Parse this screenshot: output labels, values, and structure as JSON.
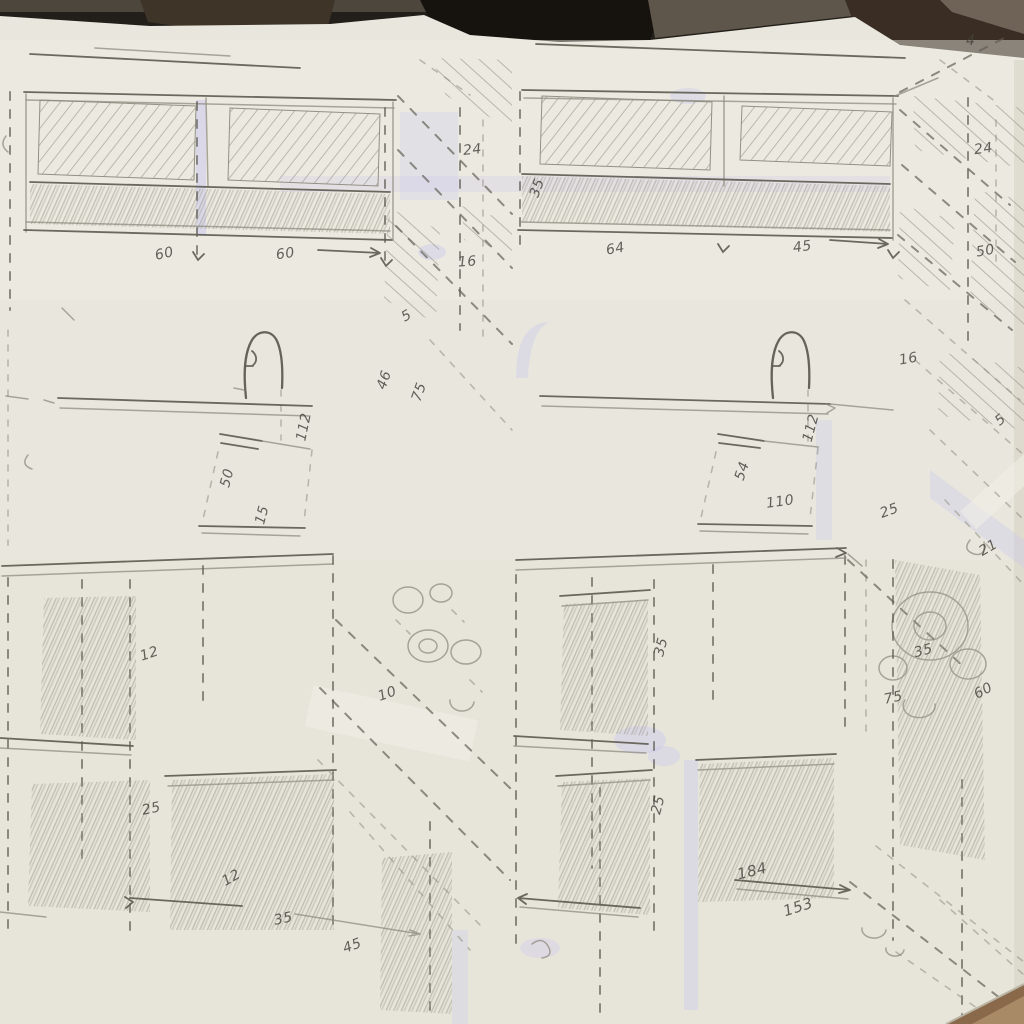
{
  "colors": {
    "paper": "#e9e7dd",
    "pencil": "#5f5c53",
    "pencil_light": "#8f8c80",
    "ink": "#44423c",
    "tint": "#c7c6f0",
    "background_dark": "#221e19",
    "wood": "#8a684a"
  },
  "annotations": [
    {
      "text": "60",
      "x": 155,
      "y": 246,
      "rot": -12
    },
    {
      "text": "60",
      "x": 276,
      "y": 246,
      "rot": -8
    },
    {
      "text": "24",
      "x": 463,
      "y": 142,
      "rot": -6
    },
    {
      "text": "16",
      "x": 458,
      "y": 254,
      "rot": -4
    },
    {
      "text": "5",
      "x": 402,
      "y": 308,
      "rot": -30
    },
    {
      "text": "112",
      "x": 290,
      "y": 419,
      "rot": -78
    },
    {
      "text": "46",
      "x": 375,
      "y": 372,
      "rot": -70
    },
    {
      "text": "75",
      "x": 410,
      "y": 384,
      "rot": -70
    },
    {
      "text": "50",
      "x": 218,
      "y": 470,
      "rot": -75
    },
    {
      "text": "15",
      "x": 253,
      "y": 507,
      "rot": -75
    },
    {
      "text": "12",
      "x": 140,
      "y": 646,
      "rot": -18
    },
    {
      "text": "10",
      "x": 378,
      "y": 686,
      "rot": -20
    },
    {
      "text": "25",
      "x": 142,
      "y": 801,
      "rot": -12
    },
    {
      "text": "12",
      "x": 222,
      "y": 870,
      "rot": -30
    },
    {
      "text": "35",
      "x": 274,
      "y": 911,
      "rot": -12
    },
    {
      "text": "45",
      "x": 343,
      "y": 938,
      "rot": -20
    },
    {
      "text": "64",
      "x": 606,
      "y": 241,
      "rot": -10
    },
    {
      "text": "45",
      "x": 793,
      "y": 239,
      "rot": -8
    },
    {
      "text": "4",
      "x": 966,
      "y": 33,
      "rot": 0
    },
    {
      "text": "24",
      "x": 974,
      "y": 141,
      "rot": -8
    },
    {
      "text": "50",
      "x": 976,
      "y": 243,
      "rot": -10
    },
    {
      "text": "35",
      "x": 528,
      "y": 180,
      "rot": -70
    },
    {
      "text": "112",
      "x": 797,
      "y": 420,
      "rot": -75
    },
    {
      "text": "16",
      "x": 899,
      "y": 351,
      "rot": -10
    },
    {
      "text": "5",
      "x": 996,
      "y": 412,
      "rot": -40
    },
    {
      "text": "54",
      "x": 733,
      "y": 463,
      "rot": -72
    },
    {
      "text": "110",
      "x": 766,
      "y": 494,
      "rot": -8
    },
    {
      "text": "25",
      "x": 880,
      "y": 503,
      "rot": -20
    },
    {
      "text": "21",
      "x": 979,
      "y": 540,
      "rot": -30
    },
    {
      "text": "35",
      "x": 914,
      "y": 643,
      "rot": -15
    },
    {
      "text": "75",
      "x": 884,
      "y": 690,
      "rot": -12
    },
    {
      "text": "60",
      "x": 974,
      "y": 683,
      "rot": -28
    },
    {
      "text": "35",
      "x": 652,
      "y": 639,
      "rot": -75
    },
    {
      "text": "25",
      "x": 649,
      "y": 797,
      "rot": -75
    },
    {
      "text": "184",
      "x": 737,
      "y": 862,
      "rot": -14,
      "size": 15
    },
    {
      "text": "153",
      "x": 783,
      "y": 898,
      "rot": -18,
      "size": 15
    }
  ]
}
